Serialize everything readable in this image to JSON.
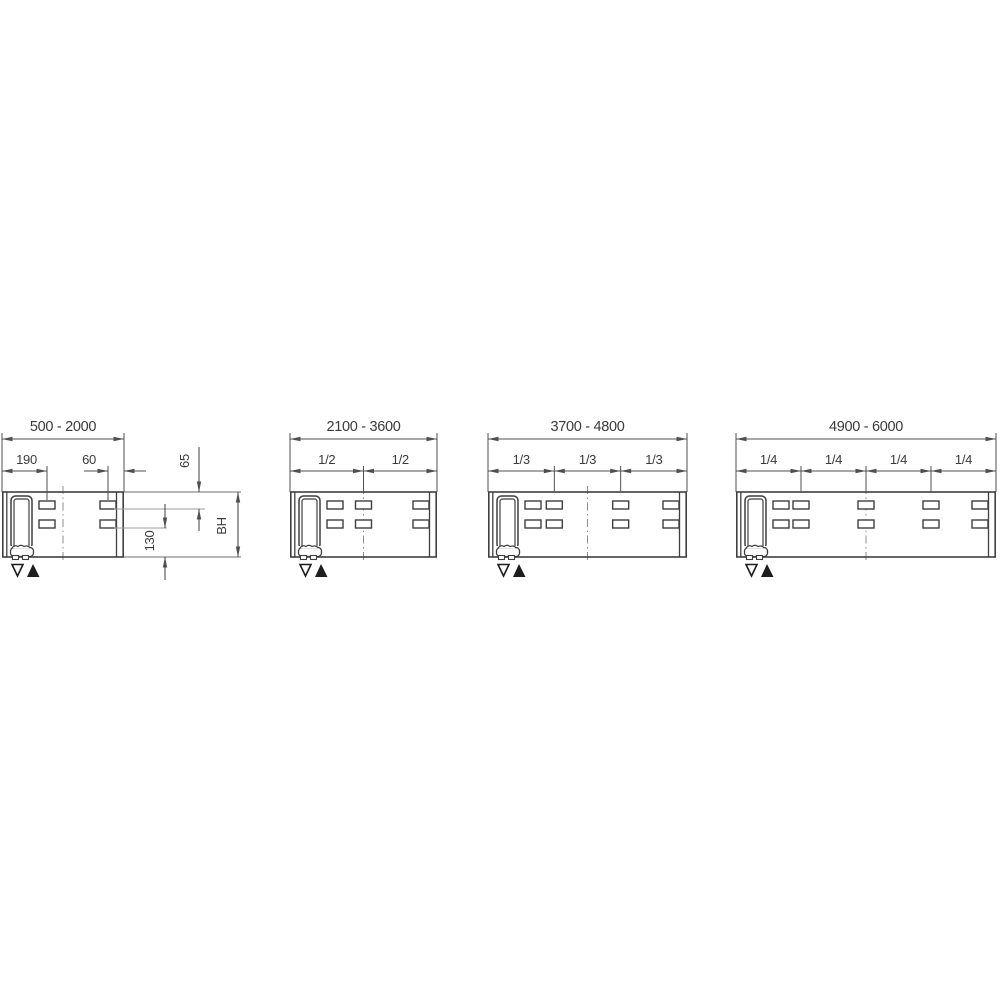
{
  "drawing": {
    "description": "beam-length-variant-dimension-diagrams",
    "colors": {
      "background": "#ffffff",
      "outline": "#3f3f3f",
      "dimension": "#4f4f4f",
      "leader": "#9b9b9b",
      "centerline": "#8c8c8c",
      "text": "#3a3a3a",
      "symbol": "#1d1d1d"
    },
    "panels": [
      {
        "id": "length-500-2000",
        "range_label": "500 - 2000",
        "fraction_labels": [],
        "dim_labels": {
          "left_slot_offset": "190",
          "right_slot_offset": "60",
          "top_to_slot_row": "65",
          "slot_row_to_bottom": "130",
          "beam_height": "BH"
        },
        "symbols": [
          "triangle-down-outline",
          "triangle-up-filled"
        ]
      },
      {
        "id": "length-2100-3600",
        "range_label": "2100 - 3600",
        "fraction_labels": [
          "1/2",
          "1/2"
        ],
        "symbols": [
          "triangle-down-outline",
          "triangle-up-filled"
        ]
      },
      {
        "id": "length-3700-4800",
        "range_label": "3700 - 4800",
        "fraction_labels": [
          "1/3",
          "1/3",
          "1/3"
        ],
        "symbols": [
          "triangle-down-outline",
          "triangle-up-filled"
        ]
      },
      {
        "id": "length-4900-6000",
        "range_label": "4900 - 6000",
        "fraction_labels": [
          "1/4",
          "1/4",
          "1/4",
          "1/4"
        ],
        "symbols": [
          "triangle-down-outline",
          "triangle-up-filled"
        ]
      }
    ]
  }
}
